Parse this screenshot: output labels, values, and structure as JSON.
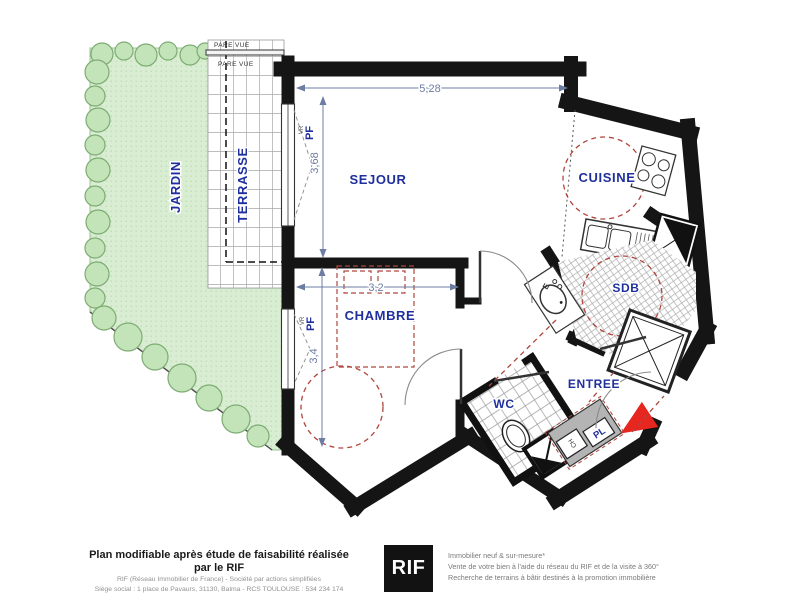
{
  "plan": {
    "rooms": {
      "jardin": "JARDIN",
      "terrasse": "TERRASSE",
      "sejour": "SEJOUR",
      "cuisine": "CUISINE",
      "chambre": "CHAMBRE",
      "sdb": "SDB",
      "wc": "WC",
      "entree": "ENTREE"
    },
    "dimensions": {
      "sejour_width": "5,28",
      "sejour_depth": "3,68",
      "chambre_width": "3,2",
      "chambre_depth": "3,4"
    },
    "annotations": {
      "pare_vue": "PARE VUE",
      "pf": "PF",
      "vr": "VR",
      "evier": "évier",
      "e": "E",
      "pl": "PL",
      "ch": "CH"
    },
    "colors": {
      "label_navy": "#1f2f9e",
      "wall_black": "#151515",
      "garden_green": "#d9edd3",
      "tree_green": "#c3e3b9",
      "furniture_dash_red": "#b0453c",
      "entrance_arrow_red": "#e6261f",
      "dimension_blue_gray": "#6d7ca3",
      "closet_gray": "#b4b4b4"
    }
  },
  "footer": {
    "headline": "Plan modifiable après étude de faisabilité réalisée par le RIF",
    "line1": "RIF (Réseau Immobilier de France)  -  Société par actions simplifiées",
    "line2": "Siège social : 1 place de Pavaurs, 31130, Balma - RCS TOULOUSE : 534 234 174",
    "logo_text": "RIF",
    "right_line1": "Immobilier neuf & sur-mesure*",
    "right_line2": "Vente de votre bien à l'aide du réseau du RIF et de la visite à 360°",
    "right_line3": "Recherche de terrains à bâtir destinés à la promotion immobilière"
  }
}
